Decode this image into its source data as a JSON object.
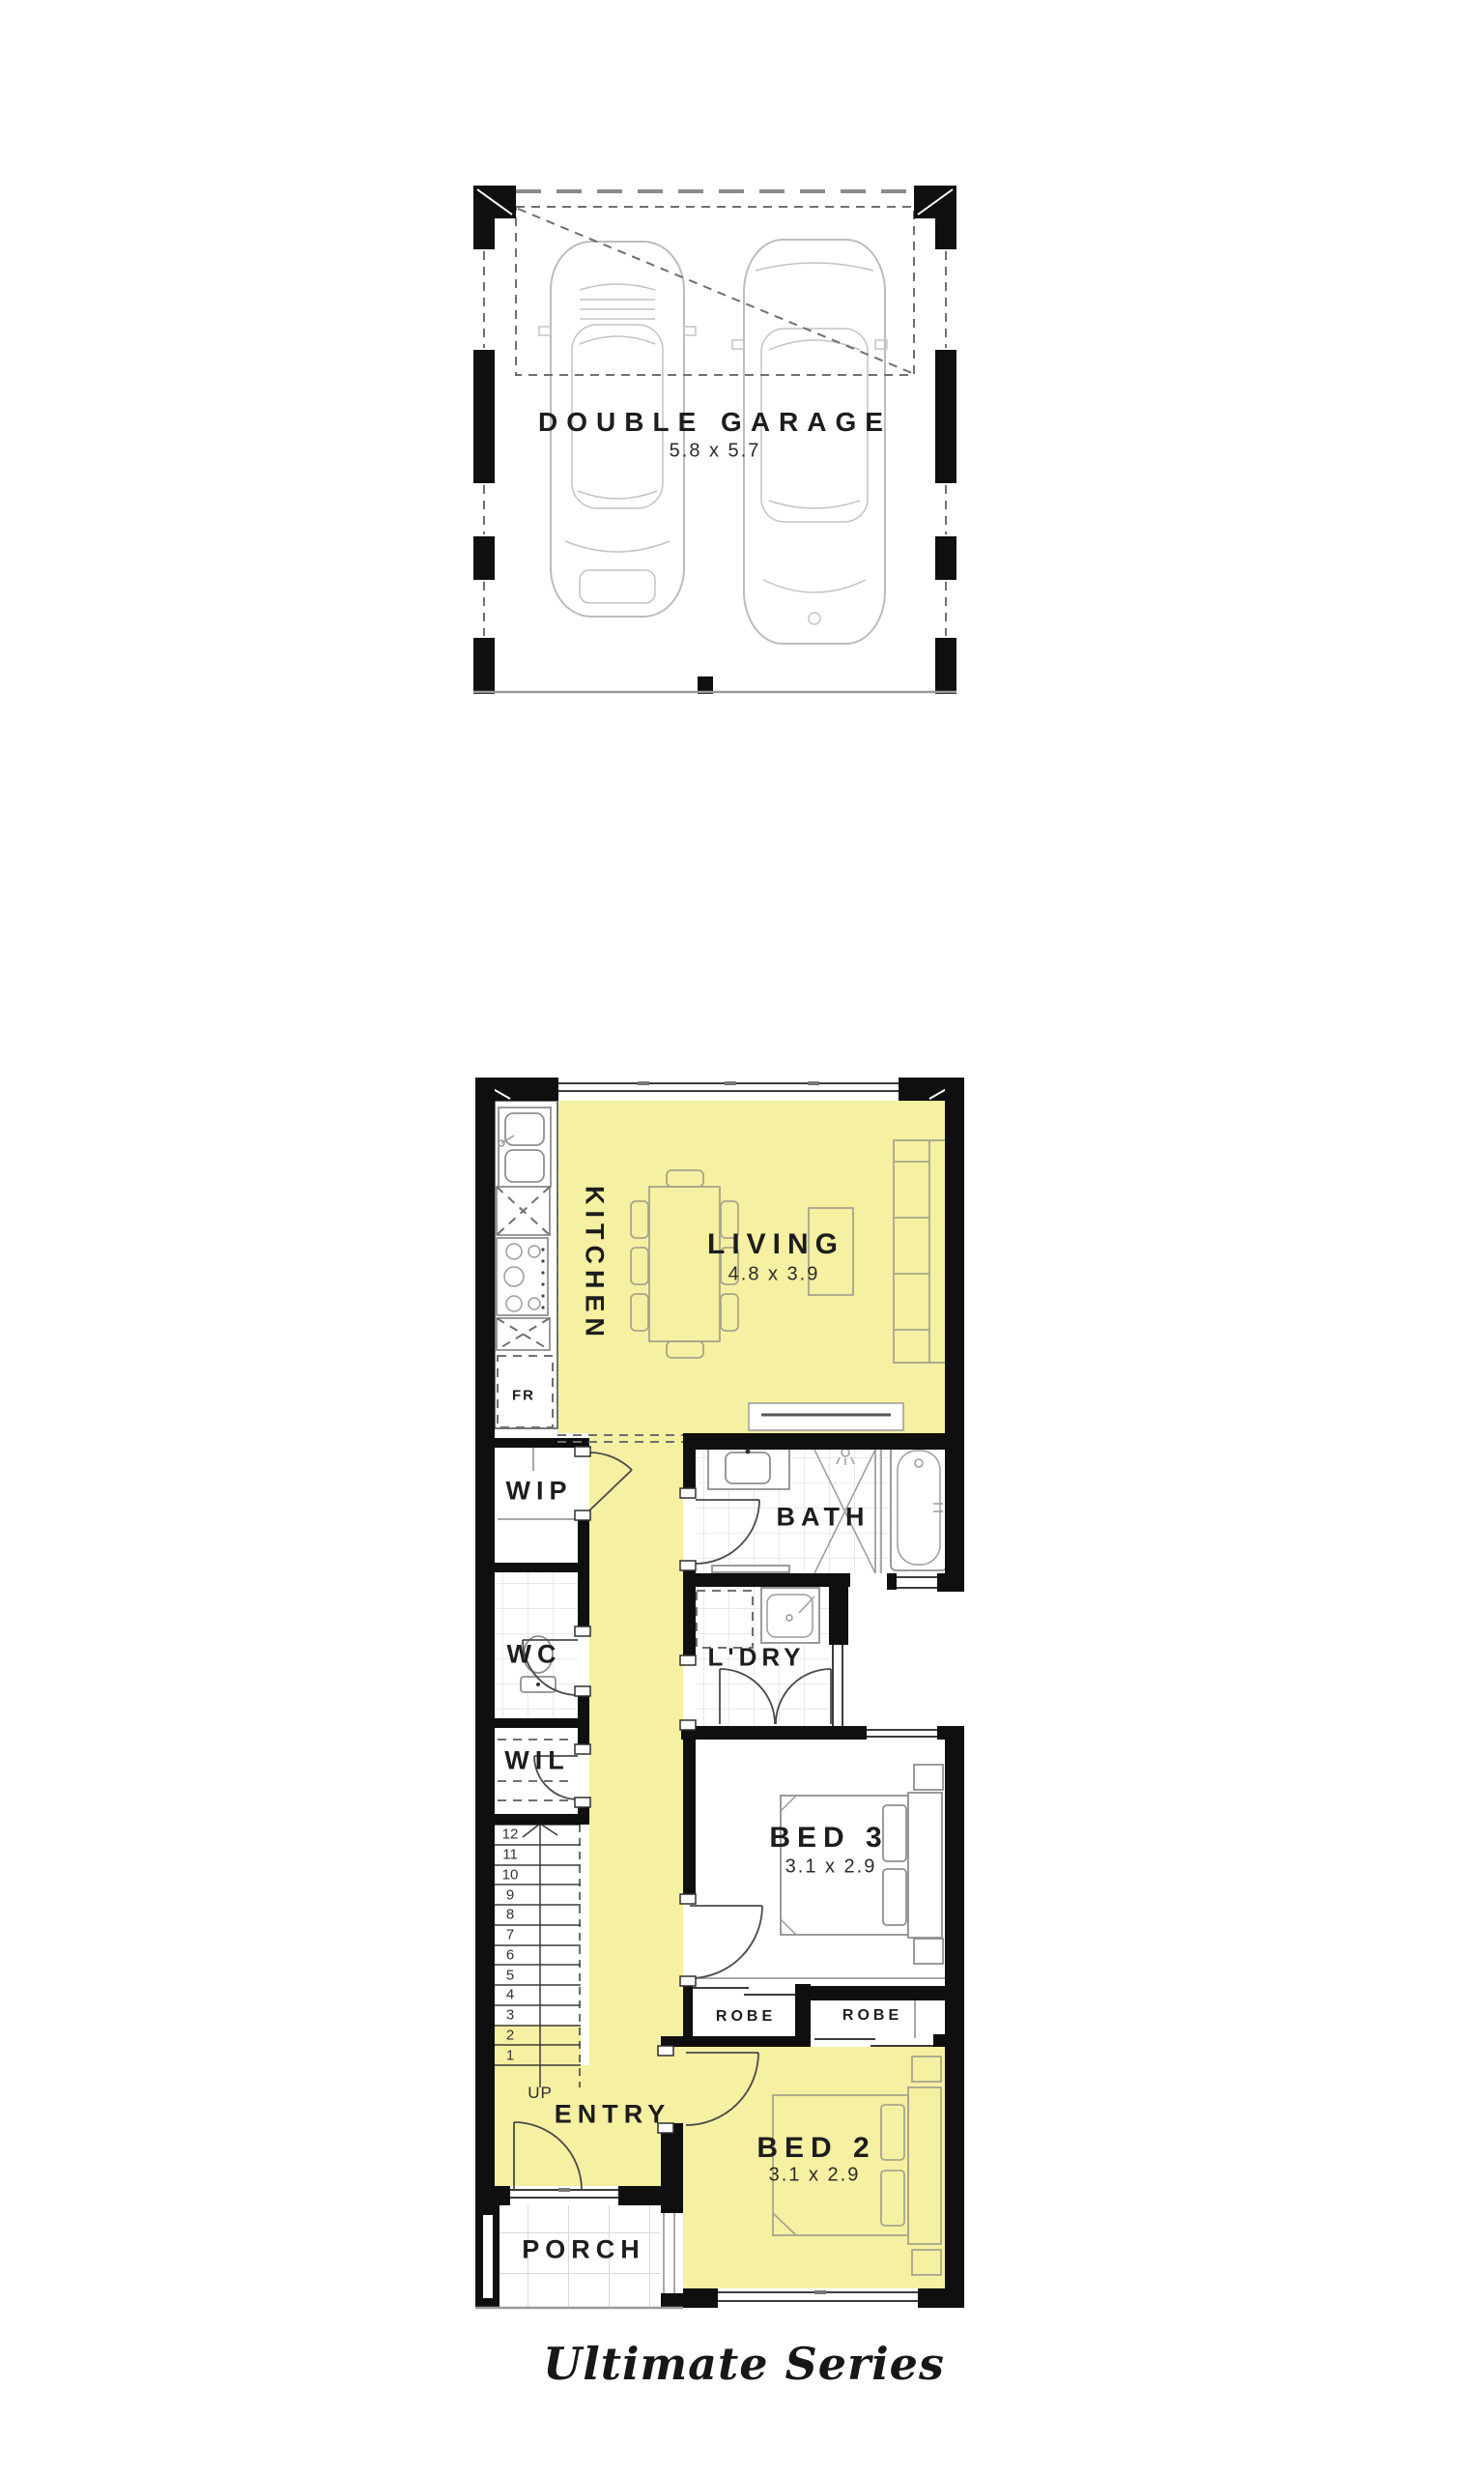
{
  "garage_plan": {
    "name": "DOUBLE GARAGE",
    "dims": "5.8 x 5.7"
  },
  "floor_plan": {
    "kitchen": "KITCHEN",
    "living": "LIVING",
    "living_dims": "4.8 x 3.9",
    "wip": "WIP",
    "wc": "WC",
    "wil": "WIL",
    "bath": "BATH",
    "ldry": "L'DRY",
    "bed3": "BED 3",
    "bed3_dims": "3.1 x 2.9",
    "robe_left": "ROBE",
    "robe_right": "ROBE",
    "bed2": "BED 2",
    "bed2_dims": "3.1 x 2.9",
    "entry": "ENTRY",
    "porch": "PORCH",
    "fridge": "FR",
    "up": "UP",
    "stairs": [
      "12",
      "11",
      "10",
      "9",
      "8",
      "7",
      "6",
      "5",
      "4",
      "3",
      "2",
      "1"
    ]
  },
  "footer": {
    "series": "Ultimate Series"
  },
  "colors": {
    "highlight": "#F6F0A2",
    "wall": "#0F0F0F",
    "fixture_yellow_zone": "#A6A68C",
    "fixture_white_zone": "#9B9B9B",
    "tile_grid": "#E2E2E2"
  }
}
